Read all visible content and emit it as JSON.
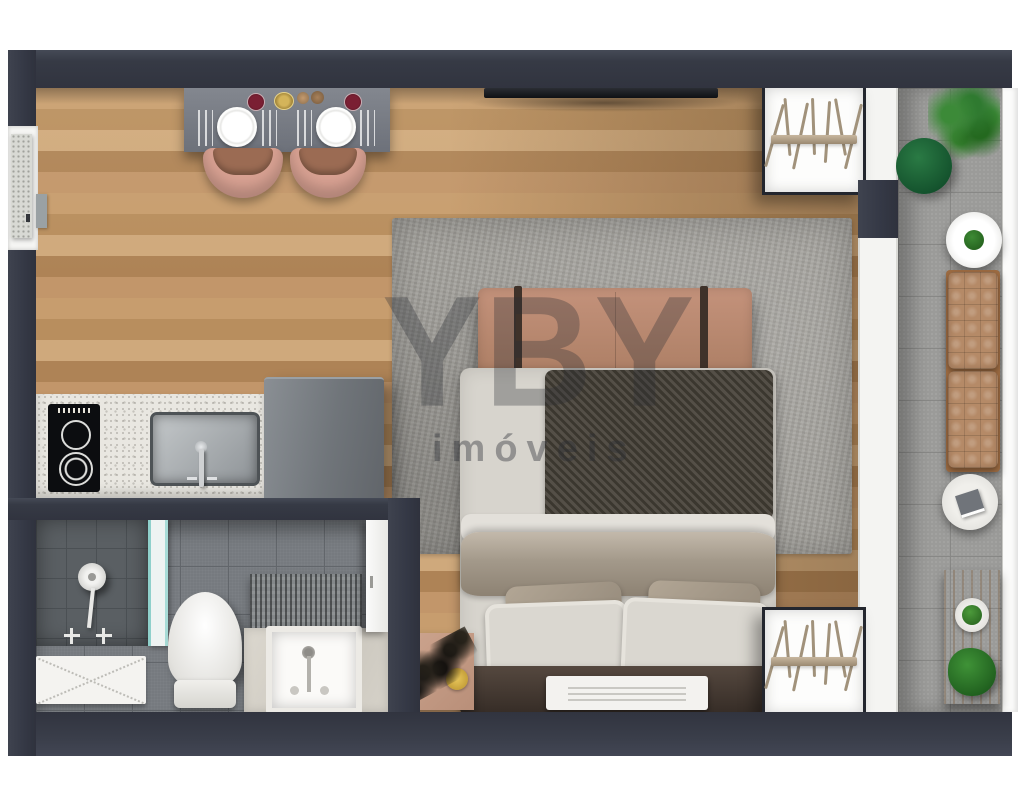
{
  "watermark": {
    "brand": "YBY",
    "tagline": "imóveis"
  },
  "palette": {
    "wall": "#363a45",
    "wood_floor": "#c79d6e",
    "rug": "#a3a19c",
    "sofa": "#bb8a70",
    "bed_throw_dark": "#46423b",
    "bedding_light": "#d7d4cd",
    "blanket_taupe": "#a3998a",
    "chair_salmon": "#d8a192",
    "headboard_brown": "#453a32",
    "balcony_tile": "#9b9b99",
    "bathroom_tile": "#75797e",
    "shower_tile": "#5a5f63",
    "counter_granite": "#e9e7e1",
    "appliance_gray": "#767b80",
    "bench_tufted": "#b58a67",
    "greenery": "#2f7a30",
    "gold_accent": "#d9b23f",
    "glass_teal": "#8fd0cb"
  },
  "scene": {
    "type": "studio-apartment-3d-floor-plan-top-view",
    "areas": [
      "dining",
      "kitchen",
      "bathroom",
      "bedroom-living",
      "balcony"
    ],
    "furniture": [
      "dining-table-for-two",
      "dining-chairs",
      "wall-tv",
      "kitchen-counter-cooktop-sink",
      "refrigerator",
      "area-rug",
      "sofa-bench",
      "double-bed",
      "nightstand",
      "open-wardrobes-with-hangers",
      "shower",
      "toilet",
      "vanity-sink",
      "bath-mat",
      "balcony-bench-cushions",
      "round-tables",
      "potted-plants"
    ]
  }
}
